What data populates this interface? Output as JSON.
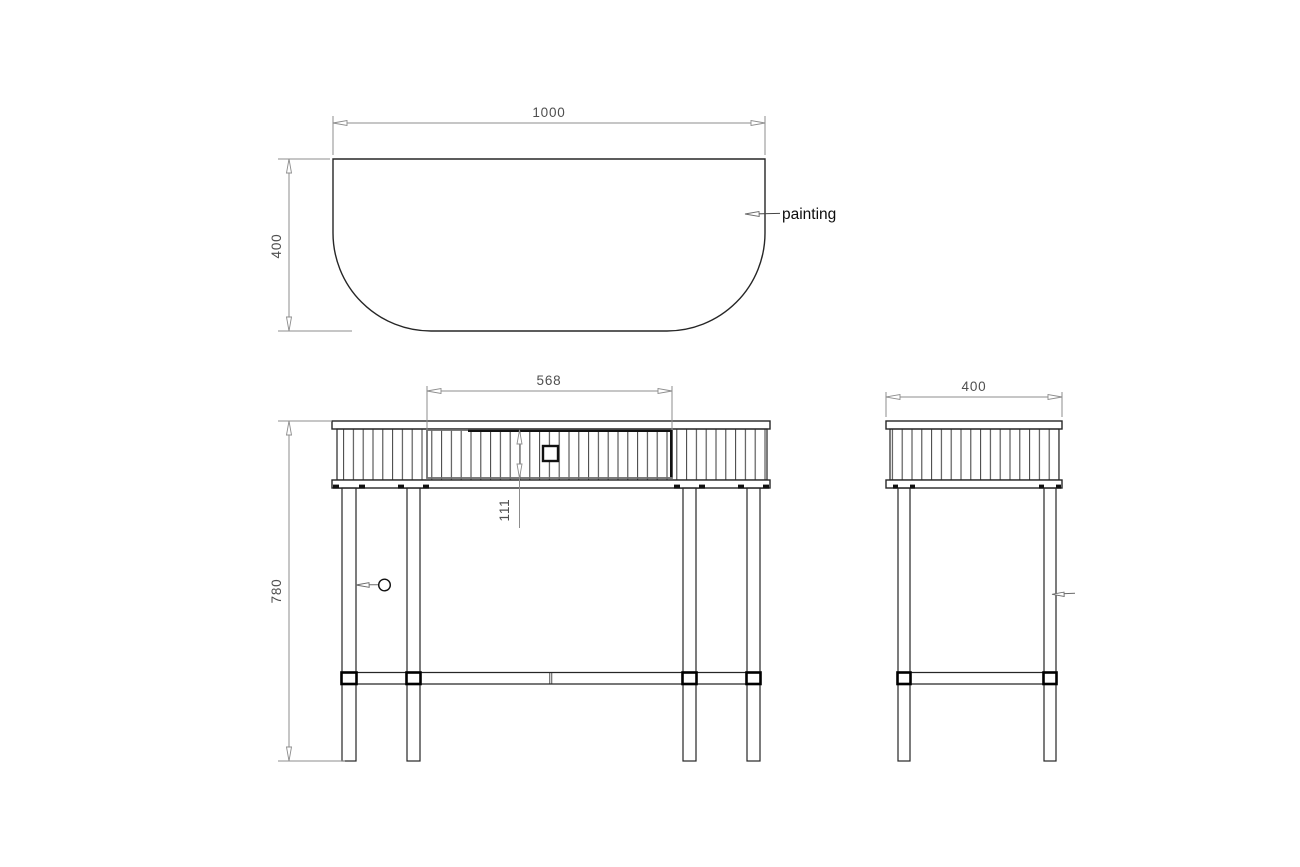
{
  "drawing": {
    "type": "furniture-technical-drawing",
    "top_view": {
      "width_label": "1000",
      "depth_label": "400",
      "callout_label": "painting"
    },
    "front_view": {
      "drawer_width_label": "568",
      "drawer_height_label": "111",
      "height_label": "780"
    },
    "side_view": {
      "depth_label": "400"
    },
    "colors": {
      "object_line": "#262626",
      "dimension_line": "#8c8c8c",
      "dimension_text": "#4f4f4f",
      "annotation_text": "#0d0d0d",
      "background": "#ffffff"
    }
  }
}
